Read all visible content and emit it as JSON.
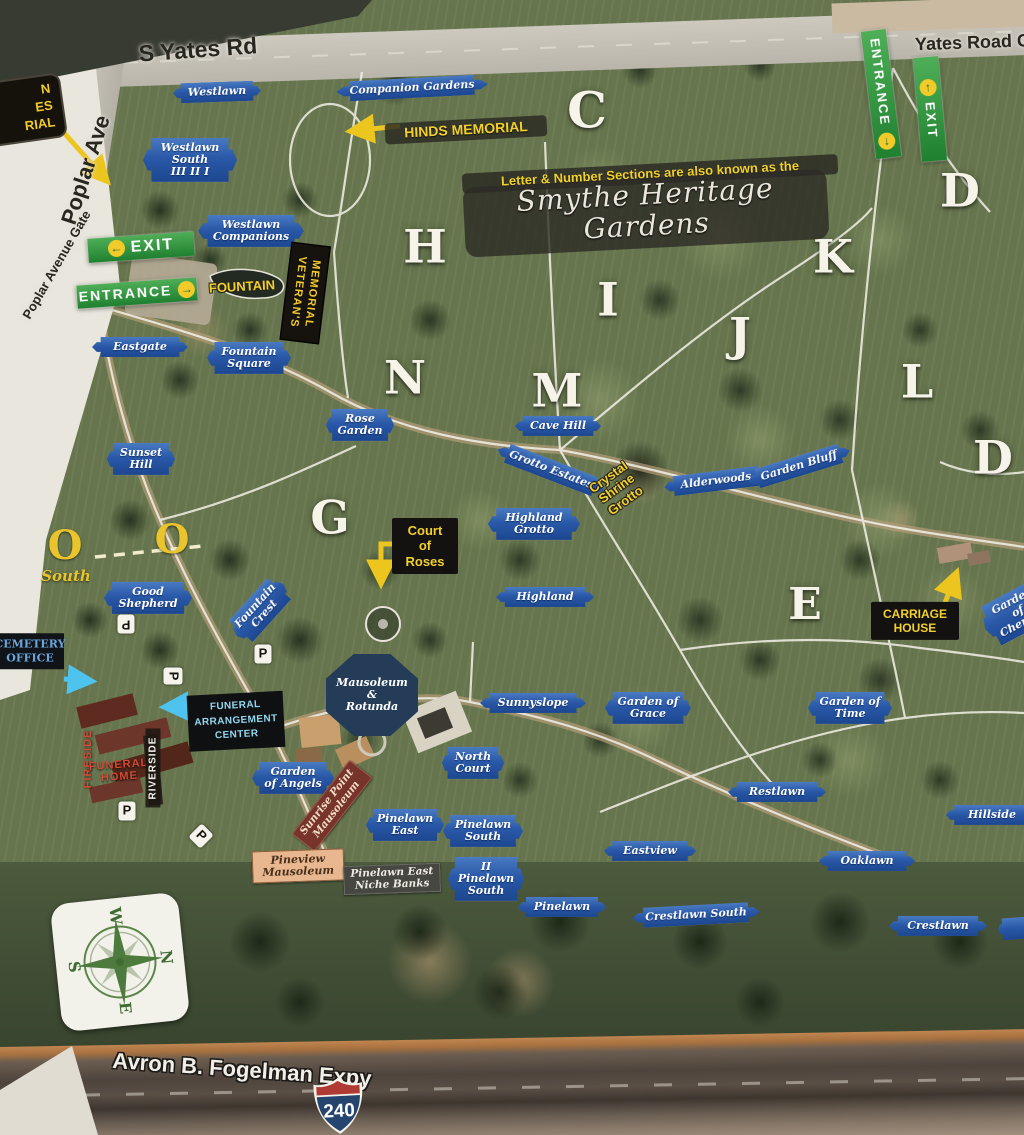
{
  "roads": {
    "s_yates": "S Yates Rd",
    "yates_gate": "Yates Road Ga",
    "poplar_ave": "Poplar Ave",
    "poplar_gate": "Poplar Avenue Gate",
    "expressway": "Avron B. Fogelman Expy"
  },
  "banner": {
    "note": "Letter & Number Sections are also known as the",
    "title": "Smythe Heritage Gardens"
  },
  "compass": {
    "n": "N",
    "s": "S",
    "e": "E",
    "w": "W"
  },
  "shield": {
    "number": "240"
  },
  "labels": [
    {
      "name": "road-label-s-yates",
      "cls": "roadlbl",
      "text": "S Yates Rd",
      "x": 198,
      "y": 50,
      "rot": -4,
      "fs": 23
    },
    {
      "name": "road-label-yates-road-gate",
      "cls": "roadlbl",
      "text": "Yates Road Ga",
      "x": 978,
      "y": 43,
      "rot": -2,
      "fs": 18
    },
    {
      "name": "road-label-poplar-ave",
      "cls": "roadlbl",
      "text": "Poplar Ave",
      "x": 86,
      "y": 170,
      "rot": -72,
      "fs": 22
    },
    {
      "name": "road-label-poplar-avenue-gate",
      "cls": "roadlbl poplargate",
      "text": "Poplar Avenue Gate",
      "x": 57,
      "y": 265,
      "rot": -60,
      "fs": 13
    },
    {
      "name": "road-label-expressway",
      "cls": "expwy",
      "text": "Avron B. Fogelman Expy",
      "x": 242,
      "y": 1070,
      "rot": 4,
      "fs": 22
    },
    {
      "name": "plaque-westlawn",
      "cls": "plaque",
      "text": "Westlawn",
      "x": 217,
      "y": 92,
      "rot": -2,
      "w": 88
    },
    {
      "name": "plaque-companion-gardens",
      "cls": "plaque",
      "text": "Companion Gardens",
      "x": 412,
      "y": 88,
      "rot": -3,
      "w": 152
    },
    {
      "name": "plaque-westlawn-south",
      "cls": "plaque",
      "text": "Westlawn\nSouth\nIII  II  I",
      "x": 190,
      "y": 160,
      "w": 94
    },
    {
      "name": "plaque-westlawn-companions",
      "cls": "plaque",
      "text": "Westlawn\nCompanions",
      "x": 251,
      "y": 231,
      "w": 106
    },
    {
      "name": "plaque-eastgate",
      "cls": "plaque",
      "text": "Eastgate",
      "x": 140,
      "y": 347,
      "w": 96
    },
    {
      "name": "plaque-fountain-square",
      "cls": "plaque",
      "text": "Fountain\nSquare",
      "x": 249,
      "y": 358,
      "w": 84
    },
    {
      "name": "plaque-rose-garden",
      "cls": "plaque",
      "text": "Rose\nGarden",
      "x": 360,
      "y": 425,
      "w": 68
    },
    {
      "name": "plaque-sunset-hill",
      "cls": "plaque",
      "text": "Sunset\nHill",
      "x": 141,
      "y": 459,
      "w": 68
    },
    {
      "name": "plaque-cave-hill",
      "cls": "plaque",
      "text": "Cave Hill",
      "x": 558,
      "y": 426,
      "w": 86
    },
    {
      "name": "plaque-grotto-estates",
      "cls": "plaque",
      "text": "Grotto Estates",
      "x": 551,
      "y": 470,
      "rot": 21,
      "w": 114
    },
    {
      "name": "plaque-alderwoods",
      "cls": "plaque",
      "text": "Alderwoods",
      "x": 716,
      "y": 481,
      "rot": -7,
      "w": 104
    },
    {
      "name": "plaque-garden-bluff",
      "cls": "plaque",
      "text": "Garden Bluff",
      "x": 799,
      "y": 466,
      "rot": -17,
      "w": 106
    },
    {
      "name": "plaque-highland-grotto",
      "cls": "plaque",
      "text": "Highland\nGrotto",
      "x": 534,
      "y": 524,
      "w": 92
    },
    {
      "name": "plaque-highland",
      "cls": "plaque",
      "text": "Highland",
      "x": 545,
      "y": 597,
      "w": 98
    },
    {
      "name": "plaque-good-shepherd",
      "cls": "plaque",
      "text": "Good\nShepherd",
      "x": 148,
      "y": 598,
      "w": 88
    },
    {
      "name": "plaque-fountain-crest",
      "cls": "plaque",
      "text": "Fountain\nCrest",
      "x": 260,
      "y": 610,
      "rot": -48,
      "w": 70
    },
    {
      "name": "plaque-sunnyslope",
      "cls": "plaque",
      "text": "Sunnyslope",
      "x": 533,
      "y": 703,
      "w": 106
    },
    {
      "name": "plaque-garden-of-grace",
      "cls": "plaque",
      "text": "Garden of\nGrace",
      "x": 648,
      "y": 708,
      "w": 86
    },
    {
      "name": "plaque-garden-of-time",
      "cls": "plaque",
      "text": "Garden of\nTime",
      "x": 850,
      "y": 708,
      "w": 84
    },
    {
      "name": "plaque-restlawn",
      "cls": "plaque",
      "text": "Restlawn",
      "x": 777,
      "y": 792,
      "w": 98
    },
    {
      "name": "plaque-hillside",
      "cls": "plaque",
      "text": "Hillside",
      "x": 992,
      "y": 815,
      "w": 92
    },
    {
      "name": "plaque-eastview",
      "cls": "plaque",
      "text": "Eastview",
      "x": 650,
      "y": 851,
      "w": 92
    },
    {
      "name": "plaque-oaklawn",
      "cls": "plaque",
      "text": "Oaklawn",
      "x": 867,
      "y": 861,
      "w": 96
    },
    {
      "name": "plaque-crestlawn-south",
      "cls": "plaque",
      "text": "Crestlawn South",
      "x": 696,
      "y": 915,
      "rot": -3,
      "w": 128
    },
    {
      "name": "plaque-crestlawn",
      "cls": "plaque",
      "text": "Crestlawn",
      "x": 938,
      "y": 926,
      "w": 98
    },
    {
      "name": "plaque-north-court",
      "cls": "plaque",
      "text": "North\nCourt",
      "x": 473,
      "y": 763,
      "w": 62
    },
    {
      "name": "plaque-garden-of-angels",
      "cls": "plaque",
      "text": "Garden\nof Angels",
      "x": 293,
      "y": 778,
      "w": 82
    },
    {
      "name": "plaque-pinelawn-east",
      "cls": "plaque",
      "text": "Pinelawn\nEast",
      "x": 405,
      "y": 825,
      "w": 78
    },
    {
      "name": "plaque-pinelawn-south",
      "cls": "plaque",
      "text": "Pinelawn\nSouth",
      "x": 483,
      "y": 831,
      "w": 80
    },
    {
      "name": "plaque-pinelawn-south-2",
      "cls": "plaque",
      "text": "II\nPinelawn\nSouth",
      "x": 486,
      "y": 879,
      "w": 76
    },
    {
      "name": "plaque-pinelawn",
      "cls": "plaque",
      "text": "Pinelawn",
      "x": 562,
      "y": 907,
      "w": 88
    },
    {
      "name": "plaque-garden-of-cherubs",
      "cls": "plaque",
      "text": "Garden\nof\nCherubs",
      "x": 1018,
      "y": 612,
      "rot": -28,
      "w": 74
    },
    {
      "name": "plaque-partial",
      "cls": "plaque",
      "text": "",
      "x": 1022,
      "y": 928,
      "rot": -4,
      "w": 48,
      "h": 22
    },
    {
      "name": "sign-mausoleum-rotunda",
      "cls": "octagon",
      "text": "Mausoleum\n&\nRotunda",
      "x": 372,
      "y": 695,
      "w": 92,
      "h": 82
    },
    {
      "name": "section-letter-c",
      "cls": "letter",
      "text": "C",
      "x": 587,
      "y": 110,
      "fs": 50
    },
    {
      "name": "section-letter-d-north",
      "cls": "letter",
      "text": "D",
      "x": 960,
      "y": 191,
      "fs": 46
    },
    {
      "name": "section-letter-h",
      "cls": "letter",
      "text": "H",
      "x": 425,
      "y": 247,
      "fs": 46
    },
    {
      "name": "section-letter-i",
      "cls": "letter",
      "text": "I",
      "x": 608,
      "y": 300,
      "fs": 46
    },
    {
      "name": "section-letter-j",
      "cls": "letter",
      "text": "J",
      "x": 740,
      "y": 335,
      "fs": 46
    },
    {
      "name": "section-letter-k",
      "cls": "letter",
      "text": "K",
      "x": 833,
      "y": 257,
      "fs": 46
    },
    {
      "name": "section-letter-l",
      "cls": "letter",
      "text": "L",
      "x": 917,
      "y": 382,
      "fs": 46
    },
    {
      "name": "section-letter-m",
      "cls": "letter",
      "text": "M",
      "x": 557,
      "y": 391,
      "fs": 46
    },
    {
      "name": "section-letter-n",
      "cls": "letter",
      "text": "N",
      "x": 405,
      "y": 378,
      "fs": 46
    },
    {
      "name": "section-letter-g",
      "cls": "letter",
      "text": "G",
      "x": 330,
      "y": 518,
      "fs": 46
    },
    {
      "name": "section-letter-d-east",
      "cls": "letter",
      "text": "D",
      "x": 993,
      "y": 458,
      "fs": 46
    },
    {
      "name": "section-letter-e",
      "cls": "letter",
      "text": "E",
      "x": 805,
      "y": 605,
      "fs": 44
    },
    {
      "name": "section-letter-o-west",
      "cls": "letter-y",
      "text": "O",
      "x": 65,
      "y": 546,
      "fs": 40
    },
    {
      "name": "section-letter-o-east",
      "cls": "letter-y",
      "text": "O",
      "x": 172,
      "y": 540,
      "fs": 40
    },
    {
      "name": "label-south",
      "cls": "southlbl",
      "text": "South",
      "x": 66,
      "y": 576,
      "fs": 15
    },
    {
      "name": "label-fountain",
      "cls": "ytext",
      "text": "FOUNTAIN",
      "x": 242,
      "y": 287,
      "rot": -3,
      "fs": 13
    },
    {
      "name": "label-crystal-shrine-grotto",
      "cls": "ytext",
      "text": "Crystal\nShrine\nGrotto",
      "x": 617,
      "y": 489,
      "rot": -36,
      "fs": 13
    },
    {
      "name": "band-hinds-memorial",
      "cls": "band",
      "text": "HINDS MEMORIAL",
      "x": 466,
      "y": 130,
      "rot": -3,
      "fs": 14,
      "w": 162
    },
    {
      "name": "band-section-note",
      "cls": "band",
      "text": "Letter & Number Sections are also known as the",
      "x": 650,
      "y": 174,
      "rot": -3,
      "fs": 13,
      "w": 376
    },
    {
      "name": "banner-smythe-heritage-gardens",
      "cls": "scriptband",
      "text": "Smythe Heritage Gardens",
      "x": 646,
      "y": 213,
      "rot": -3,
      "fs": 28,
      "w": 364
    },
    {
      "name": "sign-court-of-roses",
      "cls": "blackbox",
      "text": "Court\nof\nRoses",
      "x": 425,
      "y": 546,
      "fs": 13,
      "w": 66
    },
    {
      "name": "sign-carriage-house",
      "cls": "blackbox",
      "text": "CARRIAGE\nHOUSE",
      "x": 915,
      "y": 621,
      "fs": 12,
      "w": 88
    },
    {
      "name": "sign-veterans-memorial",
      "cls": "vblack",
      "text": "VETERAN'S\nMEMORIAL",
      "x": 305,
      "y": 293,
      "rot": 7,
      "fs": 11,
      "h": 96
    },
    {
      "name": "sign-cemetery-office",
      "cls": "officesign",
      "text": "CEMETERY\nOFFICE",
      "x": 30,
      "y": 651,
      "fs": 11,
      "w": 68
    },
    {
      "name": "sign-funeral-arrangement-center",
      "cls": "facsign",
      "text": "FUNERAL\nARRANGEMENT\nCENTER",
      "x": 236,
      "y": 721,
      "rot": -3,
      "fs": 10,
      "w": 96
    },
    {
      "name": "label-fireside",
      "cls": "firelbl",
      "text": "FIRESIDE",
      "x": 88,
      "y": 759,
      "rot": -90,
      "fs": 11
    },
    {
      "name": "label-funeral-home",
      "cls": "firelbl",
      "text": "FUNERAL\nHOME",
      "x": 119,
      "y": 771,
      "rot": -4,
      "fs": 11
    },
    {
      "name": "label-riverside",
      "cls": "riverlbl",
      "text": "RIVERSIDE",
      "x": 153,
      "y": 768,
      "rot": -90,
      "fs": 10
    },
    {
      "name": "sign-corner-partial",
      "cls": "cornerblack",
      "text": "N\nES\nRIAL",
      "x": 22,
      "y": 110,
      "rot": -8,
      "fs": 13,
      "w": 80
    },
    {
      "name": "sign-exit-west",
      "cls": "greensign",
      "text": "EXIT",
      "x": 141,
      "y": 247,
      "rot": -4,
      "fs": 16,
      "icon": "←",
      "iconside": "l",
      "w": 106
    },
    {
      "name": "sign-entrance-west",
      "cls": "greensign",
      "text": "ENTRANCE",
      "x": 137,
      "y": 293,
      "rot": -4,
      "fs": 14,
      "icon": "→",
      "iconside": "r",
      "w": 120
    },
    {
      "name": "sign-entrance-north",
      "cls": "greensign vert",
      "text": "ENTRANCE",
      "x": 881,
      "y": 94,
      "rot": -7,
      "fs": 13,
      "icon": "↓",
      "iconside": "b",
      "h": 128
    },
    {
      "name": "sign-exit-north",
      "cls": "greensign vert",
      "text": "EXIT",
      "x": 930,
      "y": 109,
      "rot": -5,
      "fs": 13,
      "icon": "↑",
      "iconside": "t",
      "h": 104
    },
    {
      "name": "parking-sign",
      "cls": "psign",
      "text": "P",
      "x": 126,
      "y": 624,
      "rot": 180
    },
    {
      "name": "parking-sign",
      "cls": "psign",
      "text": "P",
      "x": 263,
      "y": 654
    },
    {
      "name": "parking-sign",
      "cls": "psign",
      "text": "P",
      "x": 173,
      "y": 676,
      "rot": 90
    },
    {
      "name": "parking-sign",
      "cls": "psign",
      "text": "P",
      "x": 127,
      "y": 811
    },
    {
      "name": "parking-sign",
      "cls": "psign",
      "text": "P",
      "x": 201,
      "y": 836,
      "rot": 45
    },
    {
      "name": "sign-sunrise-point-mausoleum",
      "cls": "brownsign",
      "text": "Sunrise Point\nMausoleum",
      "x": 332,
      "y": 806,
      "rot": -52,
      "fs": 10.5
    },
    {
      "name": "sign-pineview-mausoleum",
      "cls": "tansign",
      "text": "Pineview\nMausoleum",
      "x": 298,
      "y": 866,
      "rot": -2,
      "fs": 11
    },
    {
      "name": "sign-pinelawn-east-niche-banks",
      "cls": "graysign",
      "text": "Pinelawn East\nNiche Banks",
      "x": 392,
      "y": 879,
      "rot": -2,
      "fs": 10.5
    }
  ]
}
